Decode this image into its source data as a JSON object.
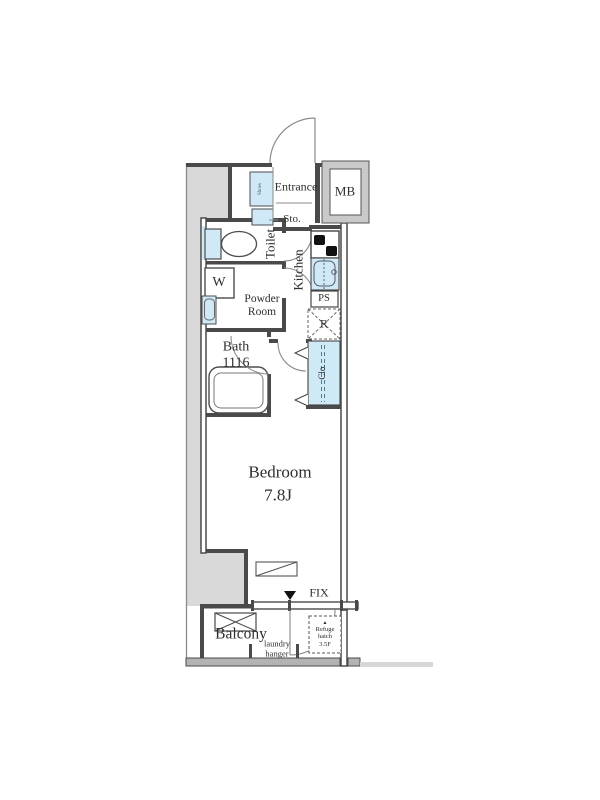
{
  "plan": {
    "title": "studio apartment floor plan",
    "labels": {
      "entrance": "Entrance",
      "mb": "MB",
      "storage": "Sto.",
      "shoes": "Shoes",
      "toilet": "Toilet",
      "washer": "W",
      "powder_room": "Powder\nRoom",
      "kitchen": "Kitchen",
      "pipe_space": "PS",
      "refrigerator": "R",
      "closet": "Clo.",
      "bath": "Bath\n1116",
      "bedroom": "Bedroom",
      "bedroom_size": "7.8J",
      "fix_window": "FIX",
      "balcony": "Balcony",
      "laundry_hanger": "laundry\nhanger",
      "refuge_marker": "▲",
      "refuge_hatch": "Refuge\nhatch\n3.5F"
    },
    "colors": {
      "wall": "#4a4a4a",
      "outside_fill": "#d9d9d9",
      "fixture_fill": "#cfe9f6",
      "thin_line": "#8a8a8a"
    }
  }
}
